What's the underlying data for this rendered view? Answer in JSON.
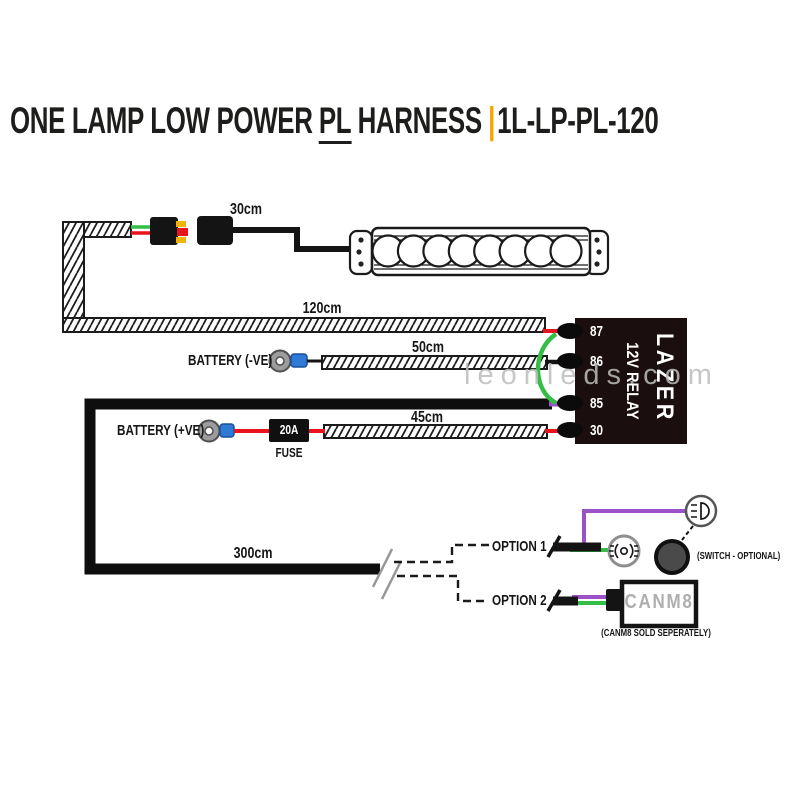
{
  "title": {
    "part1": "ONE LAMP LOW POWER",
    "underlined": "PL",
    "part2": "HARNESS",
    "separator": "|",
    "code": "1L-LP-PL-120"
  },
  "lengths": {
    "lamp_lead": "30cm",
    "main_lead": "120cm",
    "battery_neg_lead": "50cm",
    "battery_pos_lead": "45cm",
    "loom_lead": "300cm"
  },
  "labels": {
    "battery_neg": "BATTERY (-VE)",
    "battery_pos": "BATTERY (+VE)",
    "fuse_rating": "20A",
    "fuse": "FUSE"
  },
  "relay": {
    "terminals": [
      "87",
      "86",
      "85",
      "30"
    ],
    "label": "12V RELAY",
    "brand": "LAZER"
  },
  "options": {
    "option1": "OPTION 1",
    "option2": "OPTION 2",
    "switch_note": "(SWITCH - OPTIONAL)",
    "canm8": "CANM8",
    "canm8_note": "(CANM8 SOLD SEPERATELY)"
  },
  "watermark": "leonleds.com",
  "colors": {
    "red": "#E8131C",
    "green": "#35BE46",
    "purple": "#9B52C8",
    "blue": "#2E7BD6",
    "yellow": "#F0B400",
    "orange_accent": "#F7A600",
    "relay_bg": "#1A0E0E",
    "switch_gray": "#4A4A4A",
    "terminal_gray": "#9C9C9C",
    "canm8_text_gray": "#AFAFAF",
    "watermark_gray": "#BDBDBD",
    "wire_black": "#121212"
  }
}
